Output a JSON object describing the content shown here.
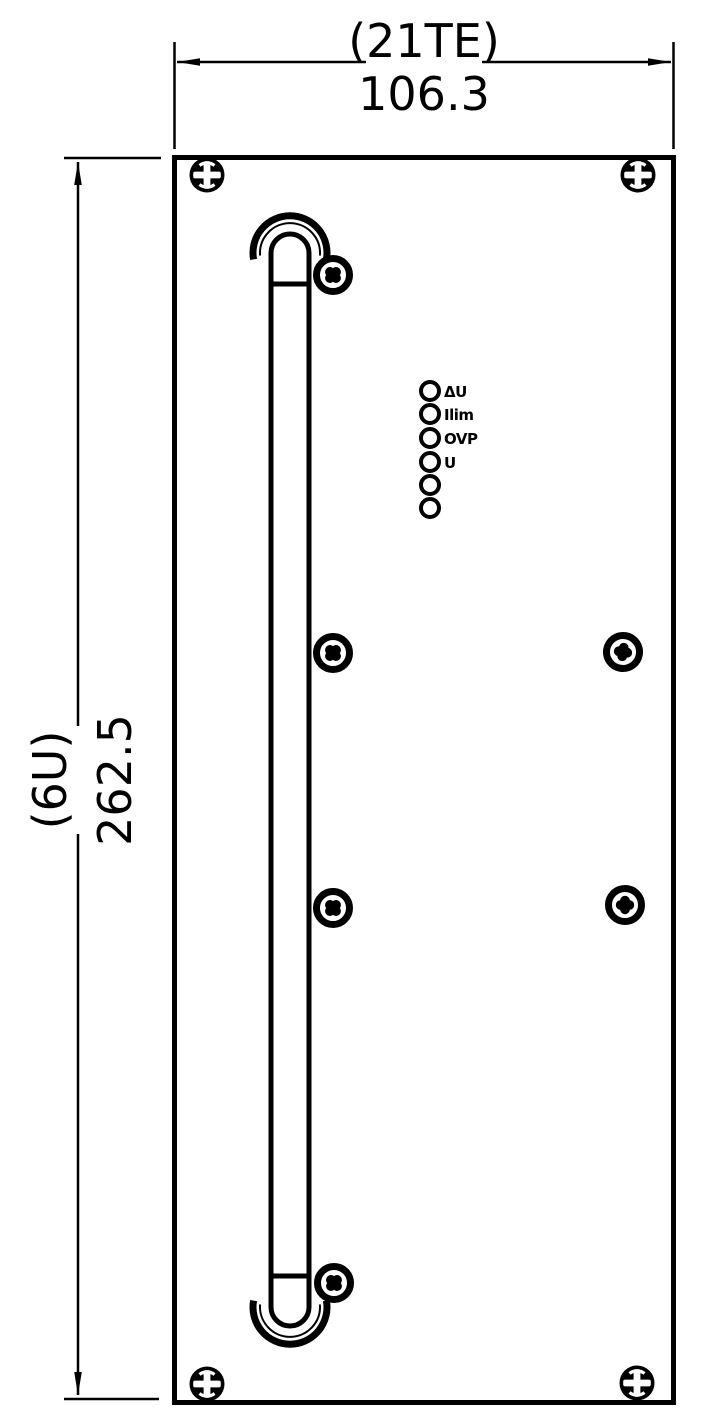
{
  "drawing": {
    "kind": "rack front panel engineering drawing",
    "width_dimension": {
      "designation": "(21TE)",
      "value": "106.3"
    },
    "height_dimension": {
      "designation": "(6U)",
      "value": "262.5"
    },
    "leds": {
      "labels": [
        "ΔU",
        "Ilim",
        "OVP",
        "U",
        "",
        ""
      ]
    },
    "colors": {
      "line": "#000000",
      "background": "#ffffff"
    }
  }
}
